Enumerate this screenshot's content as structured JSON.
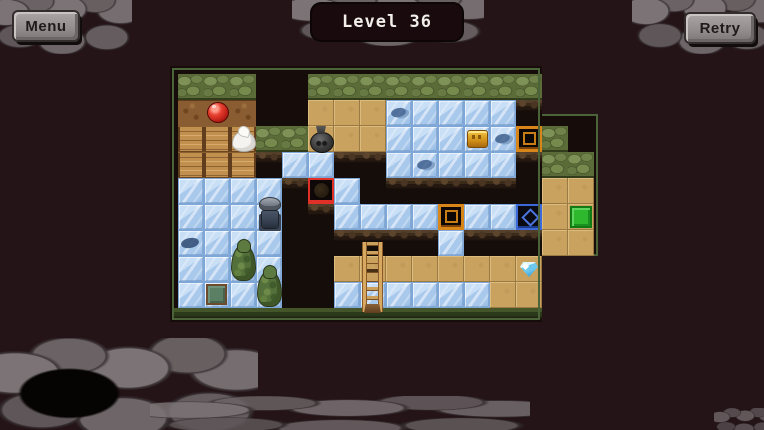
{
  "title": "Level 36",
  "buttons": {
    "menu": "Menu",
    "retry": "Retry"
  },
  "colors": {
    "background": "#241418",
    "border_green": "#4b6338",
    "ice": "#a9c9ec",
    "sand": "#c9a260",
    "grass": "#5b6c38",
    "wood": "#c1904e",
    "red_target": "#e03028",
    "orange_target": "#d8861a",
    "blue_target": "#3d68d8",
    "exit_green": "#2eb82e",
    "stone": "#766e70"
  },
  "level": {
    "tile_size": 26,
    "legend": {
      "G": "grass-wall",
      "D": "dirt",
      "W": "wood-planks",
      "T": "sand-floor",
      "I": "ice",
      "V": "pit",
      "X": "outside",
      "R": "red-ball-target",
      "O": "crate-target",
      "B": "gem-target"
    },
    "tilemap": [
      "GGGXXGGGGGGGGGXX",
      "DDDXXTTTIIIIIVXX",
      "WWWGGTTTIIIIIOGX",
      "WWWVIIVVIIIIIVGG",
      "IIIIVRIVVVVVVVTT",
      "IIIIVVIIIIOIIBTT",
      "IIIIVVVVVVIVVVTT",
      "IIIIVVTTTTTTTTXX",
      "IIIIVVIIIIIITTXX"
    ],
    "objects": [
      {
        "type": "red-ball",
        "col": 1,
        "row": 1
      },
      {
        "type": "white-blob",
        "col": 2,
        "row": 2
      },
      {
        "type": "bomb",
        "col": 5,
        "row": 2
      },
      {
        "type": "gold-crate",
        "col": 11,
        "row": 2
      },
      {
        "type": "ice-spot",
        "col": 8,
        "row": 1
      },
      {
        "type": "ice-spot",
        "col": 12,
        "row": 2
      },
      {
        "type": "ice-spot",
        "col": 9,
        "row": 3
      },
      {
        "type": "player",
        "col": 3,
        "row": 5
      },
      {
        "type": "fish-shadow",
        "col": 0,
        "row": 6
      },
      {
        "type": "tree",
        "col": 2,
        "row": 7
      },
      {
        "type": "tree",
        "col": 3,
        "row": 8
      },
      {
        "type": "green-plate",
        "col": 1,
        "row": 8
      },
      {
        "type": "ladder",
        "col": 7,
        "row": 6
      },
      {
        "type": "blue-gem",
        "col": 13,
        "row": 7
      },
      {
        "type": "exit-pad",
        "col": 15,
        "row": 5
      }
    ]
  }
}
